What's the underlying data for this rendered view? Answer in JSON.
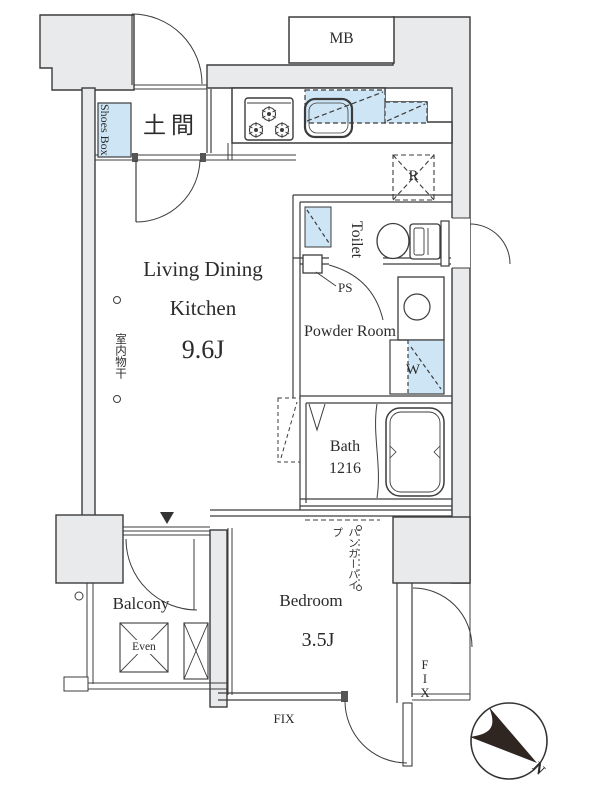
{
  "plan": {
    "labels": {
      "mb": "MB",
      "entrance": "土間",
      "shoes_box": "Shoes Box",
      "ldk_line1": "Living Dining",
      "ldk_line2": "Kitchen",
      "ldk_size": "9.6J",
      "toilet": "Toilet",
      "ps": "PS",
      "powder_room": "Powder Room",
      "washer": "W",
      "refrigerator": "R",
      "bath": "Bath",
      "bath_size": "1216",
      "bedroom": "Bedroom",
      "bedroom_size": "3.5J",
      "balcony": "Balcony",
      "hatch": "Even",
      "fix_window_bottom": "FIX",
      "fix_window_right": "FIX",
      "hanger_pipe": "ハンガーパイプ",
      "indoor_laundry": "室内物干",
      "compass_north": "N"
    },
    "colors": {
      "wall_fill": "#e9eaec",
      "fixture_blue": "#cde5f5",
      "line": "#3c3c3c"
    }
  }
}
